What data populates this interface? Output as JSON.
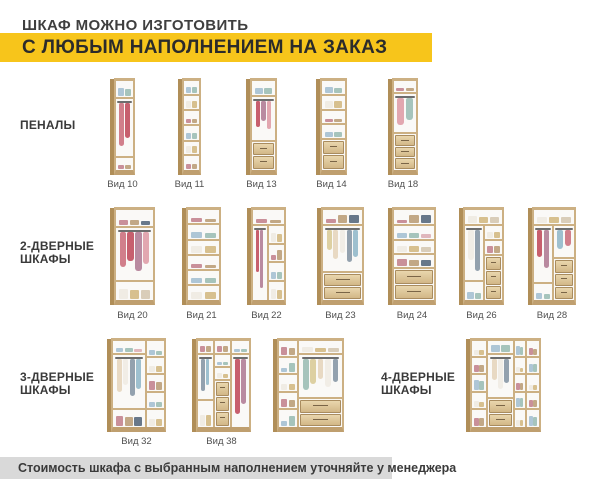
{
  "header": {
    "title_line1": "ШКАФ МОЖНО ИЗГОТОВИТЬ",
    "title_line2": "С ЛЮБЫМ НАПОЛНЕНИЕМ НА ЗАКАЗ"
  },
  "colors": {
    "accent_yellow": "#f7c51b",
    "footer_band": "#d9d9d9",
    "wood": "#ccb083"
  },
  "footer": {
    "note": "Стоимость шкафа с выбранным наполнением уточняйте у менеджера"
  },
  "sections": [
    {
      "id": "penaly",
      "label_lines": [
        "ПЕНАЛЫ"
      ],
      "cabinets": [
        {
          "id": "vid10",
          "label": "Вид 10",
          "interior": {
            "cols": [
              {
                "w": 1,
                "zones": [
                  {
                    "t": "items",
                    "h": 20
                  },
                  {
                    "t": "hang",
                    "h": 66
                  },
                  {
                    "t": "items",
                    "h": 14
                  }
                ]
              }
            ]
          }
        },
        {
          "id": "vid11",
          "label": "Вид 11",
          "interior": {
            "cols": [
              {
                "w": 1,
                "zones": [
                  {
                    "t": "items",
                    "h": 17
                  },
                  {
                    "t": "items",
                    "h": 17
                  },
                  {
                    "t": "items",
                    "h": 17
                  },
                  {
                    "t": "items",
                    "h": 17
                  },
                  {
                    "t": "items",
                    "h": 16
                  },
                  {
                    "t": "items",
                    "h": 16
                  }
                ]
              }
            ]
          }
        },
        {
          "id": "vid13",
          "label": "Вид 13",
          "interior": {
            "cols": [
              {
                "w": 1,
                "zones": [
                  {
                    "t": "items",
                    "h": 18
                  },
                  {
                    "t": "hang",
                    "h": 50
                  },
                  {
                    "t": "drawers",
                    "n": 2,
                    "h": 32
                  }
                ]
              }
            ]
          }
        },
        {
          "id": "vid14",
          "label": "Вид 14",
          "interior": {
            "cols": [
              {
                "w": 1,
                "zones": [
                  {
                    "t": "items",
                    "h": 17
                  },
                  {
                    "t": "items",
                    "h": 17
                  },
                  {
                    "t": "items",
                    "h": 16
                  },
                  {
                    "t": "items",
                    "h": 16
                  },
                  {
                    "t": "drawers",
                    "n": 2,
                    "h": 34
                  }
                ]
              }
            ]
          }
        },
        {
          "id": "vid18",
          "label": "Вид 18",
          "interior": {
            "cols": [
              {
                "w": 1,
                "zones": [
                  {
                    "t": "items",
                    "h": 15
                  },
                  {
                    "t": "hang",
                    "h": 45
                  },
                  {
                    "t": "drawers",
                    "n": 3,
                    "h": 40
                  }
                ]
              }
            ]
          }
        }
      ]
    },
    {
      "id": "d2",
      "label_lines": [
        "2-ДВЕРНЫЕ",
        "ШКАФЫ"
      ],
      "cabinets": [
        {
          "id": "vid20",
          "label": "Вид 20",
          "interior": {
            "cols": [
              {
                "w": 1,
                "zones": [
                  {
                    "t": "items",
                    "h": 20
                  },
                  {
                    "t": "hang",
                    "h": 60
                  },
                  {
                    "t": "items",
                    "h": 20
                  }
                ]
              }
            ]
          }
        },
        {
          "id": "vid21",
          "label": "Вид 21",
          "interior": {
            "cols": [
              {
                "w": 1,
                "zones": [
                  {
                    "t": "items",
                    "h": 17
                  },
                  {
                    "t": "items",
                    "h": 17
                  },
                  {
                    "t": "items",
                    "h": 17
                  },
                  {
                    "t": "items",
                    "h": 17
                  },
                  {
                    "t": "items",
                    "h": 16
                  },
                  {
                    "t": "items",
                    "h": 16
                  }
                ]
              }
            ]
          }
        },
        {
          "id": "vid22",
          "label": "Вид 22",
          "interior": {
            "top": [
              {
                "t": "items",
                "h": 18
              }
            ],
            "cols": [
              {
                "w": 0.5,
                "zones": [
                  {
                    "t": "hang",
                    "h": 100
                  }
                ]
              },
              {
                "w": 0.5,
                "zones": [
                  {
                    "t": "items",
                    "h": 25
                  },
                  {
                    "t": "items",
                    "h": 25
                  },
                  {
                    "t": "items",
                    "h": 25
                  },
                  {
                    "t": "items",
                    "h": 25
                  }
                ]
              }
            ]
          }
        },
        {
          "id": "vid23",
          "label": "Вид 23",
          "interior": {
            "cols": [
              {
                "w": 1,
                "zones": [
                  {
                    "t": "items",
                    "h": 18
                  },
                  {
                    "t": "hang",
                    "h": 52
                  },
                  {
                    "t": "drawers",
                    "n": 2,
                    "h": 30
                  }
                ]
              }
            ]
          }
        },
        {
          "id": "vid24",
          "label": "Вид 24",
          "interior": {
            "cols": [
              {
                "w": 1,
                "zones": [
                  {
                    "t": "items",
                    "h": 18
                  },
                  {
                    "t": "items",
                    "h": 16
                  },
                  {
                    "t": "items",
                    "h": 16
                  },
                  {
                    "t": "items",
                    "h": 16
                  },
                  {
                    "t": "drawers",
                    "n": 2,
                    "h": 34
                  }
                ]
              }
            ]
          }
        },
        {
          "id": "vid26",
          "label": "Вид 26",
          "interior": {
            "top": [
              {
                "t": "items",
                "h": 18
              }
            ],
            "cols": [
              {
                "w": 0.55,
                "zones": [
                  {
                    "t": "hang",
                    "h": 75
                  },
                  {
                    "t": "items",
                    "h": 25
                  }
                ]
              },
              {
                "w": 0.45,
                "zones": [
                  {
                    "t": "items",
                    "h": 20
                  },
                  {
                    "t": "items",
                    "h": 20
                  },
                  {
                    "t": "drawers",
                    "n": 3,
                    "h": 60
                  }
                ]
              }
            ]
          }
        },
        {
          "id": "vid28",
          "label": "Вид 28",
          "interior": {
            "top": [
              {
                "t": "items",
                "h": 18
              }
            ],
            "cols": [
              {
                "w": 0.5,
                "zones": [
                  {
                    "t": "hang",
                    "h": 78
                  },
                  {
                    "t": "items",
                    "h": 22
                  }
                ]
              },
              {
                "w": 0.5,
                "zones": [
                  {
                    "t": "hang",
                    "h": 45
                  },
                  {
                    "t": "drawers",
                    "n": 3,
                    "h": 55
                  }
                ]
              }
            ]
          }
        }
      ]
    },
    {
      "id": "d3",
      "label_lines": [
        "3-ДВЕРНЫЕ",
        "ШКАФЫ"
      ],
      "cabinets": [
        {
          "id": "vid32",
          "label": "Вид 32",
          "interior": {
            "cols": [
              {
                "w": 0.66,
                "zones": [
                  {
                    "t": "items",
                    "h": 16
                  },
                  {
                    "t": "hang",
                    "h": 64
                  },
                  {
                    "t": "items",
                    "h": 20
                  }
                ]
              },
              {
                "w": 0.34,
                "zones": [
                  {
                    "t": "items",
                    "h": 20
                  },
                  {
                    "t": "items",
                    "h": 20
                  },
                  {
                    "t": "items",
                    "h": 20
                  },
                  {
                    "t": "items",
                    "h": 20
                  },
                  {
                    "t": "items",
                    "h": 20
                  }
                ]
              }
            ]
          }
        },
        {
          "id": "vid38",
          "label": "Вид 38",
          "interior": {
            "cols": [
              {
                "w": 0.33,
                "zones": [
                  {
                    "t": "items",
                    "h": 16
                  },
                  {
                    "t": "hang",
                    "h": 54
                  },
                  {
                    "t": "items",
                    "h": 30
                  }
                ]
              },
              {
                "w": 0.34,
                "zones": [
                  {
                    "t": "items",
                    "h": 16
                  },
                  {
                    "t": "items",
                    "h": 15
                  },
                  {
                    "t": "items",
                    "h": 15
                  },
                  {
                    "t": "drawers",
                    "n": 3,
                    "h": 54
                  }
                ]
              },
              {
                "w": 0.33,
                "zones": [
                  {
                    "t": "items",
                    "h": 16
                  },
                  {
                    "t": "hang",
                    "h": 84
                  }
                ]
              }
            ]
          }
        },
        {
          "id": "d3x",
          "label": "",
          "interior": {
            "cols": [
              {
                "w": 0.32,
                "zones": [
                  {
                    "t": "items",
                    "h": 20
                  },
                  {
                    "t": "items",
                    "h": 20
                  },
                  {
                    "t": "items",
                    "h": 20
                  },
                  {
                    "t": "items",
                    "h": 20
                  },
                  {
                    "t": "items",
                    "h": 20
                  }
                ]
              },
              {
                "w": 0.68,
                "zones": [
                  {
                    "t": "items",
                    "h": 16
                  },
                  {
                    "t": "hang",
                    "h": 52
                  },
                  {
                    "t": "drawers",
                    "n": 2,
                    "h": 32
                  }
                ]
              }
            ]
          }
        }
      ]
    },
    {
      "id": "d4",
      "label_lines": [
        "4-ДВЕРНЫЕ",
        "ШКАФЫ"
      ],
      "cabinets": [
        {
          "id": "d4x",
          "label": "",
          "interior": {
            "cols": [
              {
                "w": 0.24,
                "zones": [
                  {
                    "t": "items",
                    "h": 20
                  },
                  {
                    "t": "items",
                    "h": 20
                  },
                  {
                    "t": "items",
                    "h": 20
                  },
                  {
                    "t": "items",
                    "h": 20
                  },
                  {
                    "t": "items",
                    "h": 20
                  }
                ]
              },
              {
                "w": 0.4,
                "zones": [
                  {
                    "t": "items",
                    "h": 16
                  },
                  {
                    "t": "hang",
                    "h": 52
                  },
                  {
                    "t": "drawers",
                    "n": 2,
                    "h": 32
                  }
                ]
              },
              {
                "w": 0.18,
                "zones": [
                  {
                    "t": "items",
                    "h": 20
                  },
                  {
                    "t": "items",
                    "h": 20
                  },
                  {
                    "t": "items",
                    "h": 20
                  },
                  {
                    "t": "items",
                    "h": 20
                  },
                  {
                    "t": "items",
                    "h": 20
                  }
                ]
              },
              {
                "w": 0.18,
                "zones": [
                  {
                    "t": "items",
                    "h": 20
                  },
                  {
                    "t": "items",
                    "h": 20
                  },
                  {
                    "t": "items",
                    "h": 20
                  },
                  {
                    "t": "items",
                    "h": 20
                  },
                  {
                    "t": "items",
                    "h": 20
                  }
                ]
              }
            ]
          }
        }
      ]
    }
  ]
}
